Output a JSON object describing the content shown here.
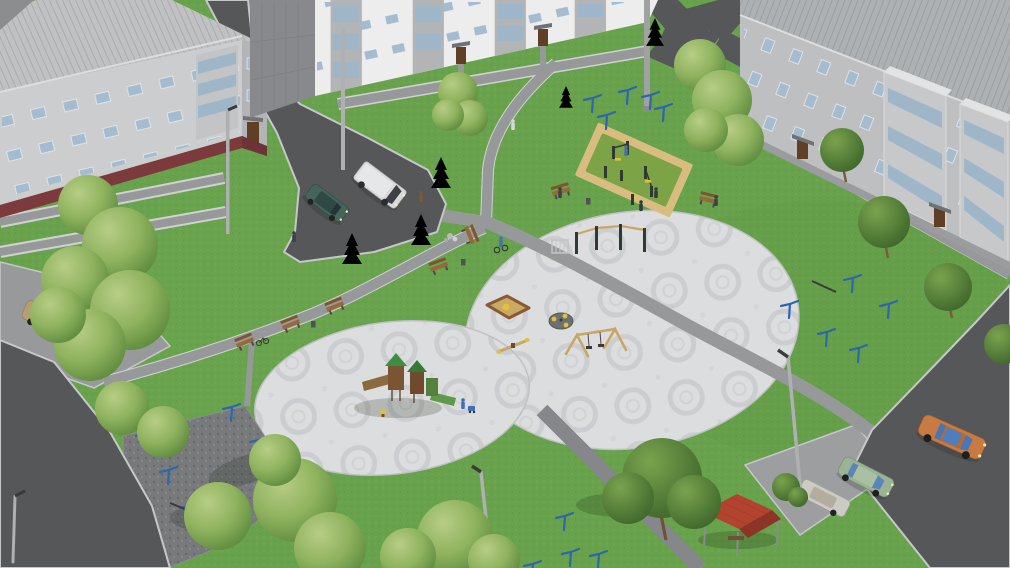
{
  "scene": {
    "type": "3D architectural visualization render",
    "view": "aerial oblique view of a residential courtyard improvement concept",
    "buildings": [
      {
        "name": "apartment-block-left",
        "floors": 3,
        "wall_color": "#cbcdcf",
        "base_color": "#7d3a3d"
      },
      {
        "name": "apartment-block-center",
        "floors": 3,
        "wall_color": "#ededee"
      },
      {
        "name": "apartment-block-right",
        "floors": 3,
        "wall_color": "#bdbfc1"
      }
    ],
    "site_features": [
      "large circular paved plaza with ornamental paving",
      "second circular plaza with children play structure",
      "outdoor gym on green rubber mat with sand border",
      "clothes-drying yard on dark gravel with blue posts",
      "asphalt driveways and parking pads",
      "pedestrian paths with benches and litter bins",
      "street lamps",
      "birch and maple trees, spruces",
      "red-roofed picnic shelter"
    ],
    "play_equipment": [
      "pull-up bar complex",
      "sandbox",
      "carousel",
      "seesaw",
      "a-frame swing",
      "play structure with slides",
      "spring rocker"
    ],
    "vehicles": [
      {
        "name": "van-white",
        "color": "#d8d9da"
      },
      {
        "name": "sedan-dark-green",
        "color": "#46645a"
      },
      {
        "name": "sedan-tan",
        "color": "#b49e72"
      },
      {
        "name": "hatchback-white",
        "color": "#d8d8d2"
      },
      {
        "name": "sedan-orange",
        "color": "#c87a43"
      },
      {
        "name": "hatchback-green",
        "color": "#9ab394"
      },
      {
        "name": "wagon-silver",
        "color": "#cbcbc3"
      }
    ],
    "counts": {
      "people": 10,
      "benches": 7,
      "street_lamps": 6,
      "drying_posts": 16,
      "litter_bins": 3
    }
  },
  "palette": {
    "grass": "#68a24c",
    "grassDark": "#578c3e",
    "grassLight": "#7fb85e",
    "road": "#565759",
    "roadEdge": "#c6c7c9",
    "path": "#96989a",
    "pathEdge": "#d0d1d2",
    "pathDark": "#85878a",
    "plaza": "#dcddde",
    "plazaRing": "#c6c8ca",
    "plazaEdge": "#bfc1c3",
    "sand": "#d9bd80",
    "gymMat": "#7da347",
    "gravel": "#77797b",
    "wallLight": "#cbcdcf",
    "wallWhite": "#ededee",
    "wallRight": "#bdbfc1",
    "wallEnd": "#87898c",
    "wallSide": "#b2b4b6",
    "baseMaroon": "#7d3a3d",
    "roofLight": "#bfc1c3",
    "roofRight": "#aeb1b3",
    "roofDark": "#8b8d8f",
    "window": "#a5bbce",
    "glass": "#9fb6c9",
    "door": "#5f4026",
    "canopy": "#6f7174",
    "bench": "#96683a",
    "benchBack": "#7d5530",
    "postBlue": "#2e66ad",
    "lamp": "#aeb0b2",
    "gazeboRoof": "#b2432f",
    "gazeboRoofDark": "#8c3425",
    "equip": "#2f3a33",
    "accentYellow": "#e2c038",
    "figure": "#3c4248"
  }
}
